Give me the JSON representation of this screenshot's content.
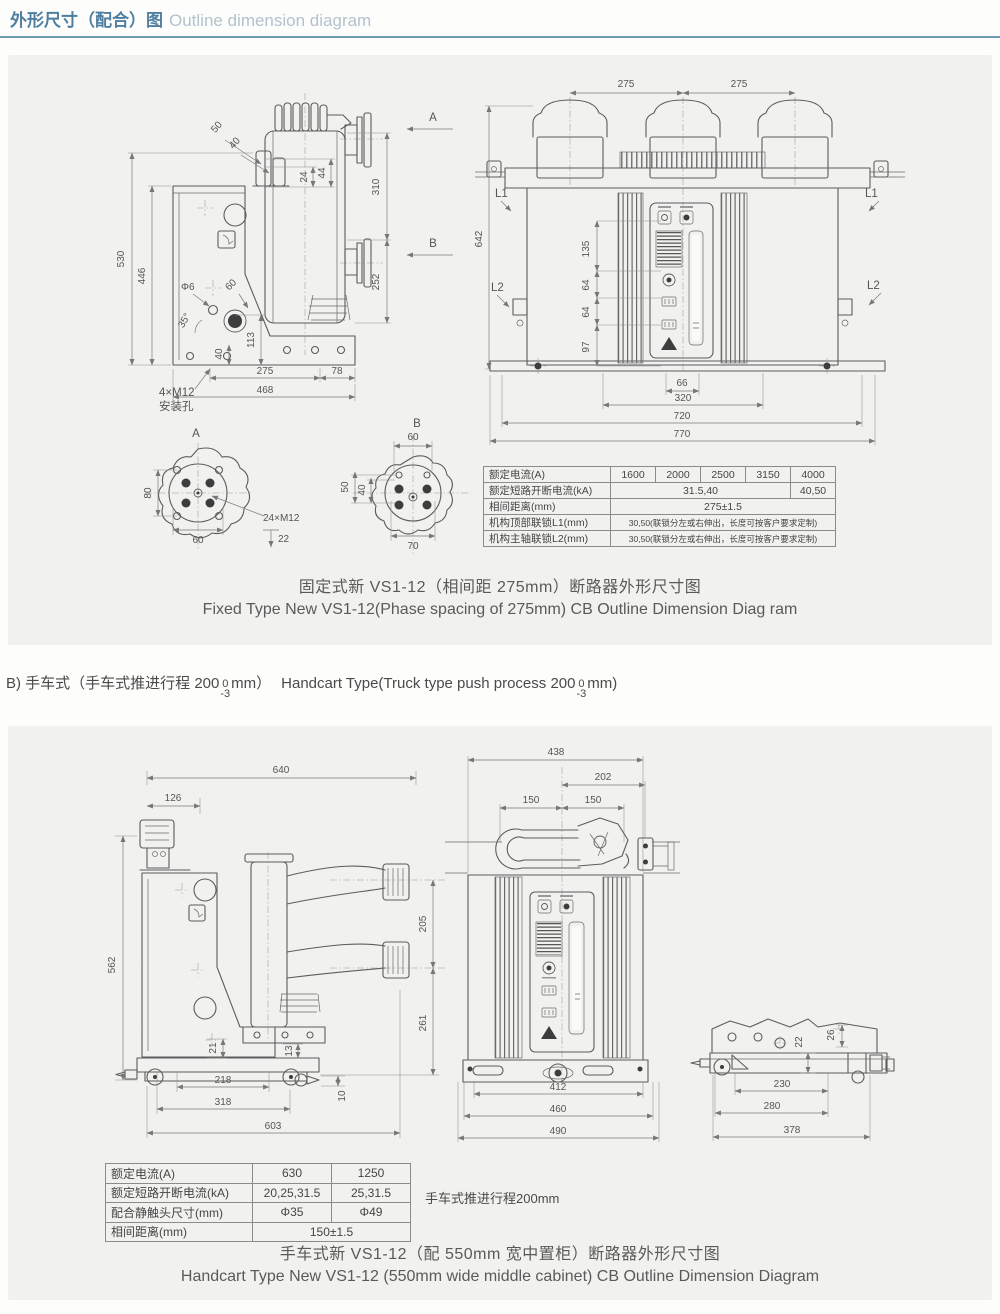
{
  "header": {
    "title_zh": "外形尺寸（配合）图",
    "title_en": "Outline dimension diagram"
  },
  "colors": {
    "title_blue": "#4f7fa0",
    "title_light": "#b2c2ce",
    "divider": "#6f9ab2",
    "panel_bg": "#f1f1ef",
    "drawing_line": "#5c5c5c",
    "text": "#4a4a4a"
  },
  "section_b": {
    "zh_a": "B) 手车式（手车式推进行程 200",
    "tol_top": "0",
    "tol_bot": "-3",
    "zh_b": "mm）",
    "en_a": "Handcart Type(Truck type push process 200",
    "en_b": "mm)"
  },
  "fixed": {
    "caption_zh": "固定式新 VS1-12（相间距 275mm）断路器外形尺寸图",
    "caption_en": "Fixed Type New VS1-12(Phase spacing of 275mm) CB Outline Dimension Diag ram",
    "table": {
      "rows": [
        {
          "label": "额定电流(A)",
          "cells": [
            "1600",
            "2000",
            "2500",
            "3150",
            "4000"
          ]
        },
        {
          "label": "额定短路开断电流(kA)",
          "cells": [
            "31.5,40",
            "40,50"
          ]
        },
        {
          "label": "相间距离(mm)",
          "cells": [
            "275±1.5"
          ]
        },
        {
          "label": "机构顶部联锁L1(mm)",
          "cells": [
            "30,50(联锁分左或右伸出，长度可按客户要求定制)"
          ]
        },
        {
          "label": "机构主轴联锁L2(mm)",
          "cells": [
            "30,50(联锁分左或右伸出，长度可按客户要求定制)"
          ]
        }
      ]
    }
  },
  "handcart": {
    "caption_zh": "手车式新 VS1-12（配 550mm 宽中置柜）断路器外形尺寸图",
    "caption_en": "Handcart Type New VS1-12 (550mm wide middle cabinet) CB Outline Dimension Diagram",
    "note": "手车式推进行程200mm",
    "table": {
      "rows": [
        {
          "label": "额定电流(A)",
          "cells": [
            "630",
            "1250"
          ]
        },
        {
          "label": "额定短路开断电流(kA)",
          "cells": [
            "20,25,31.5",
            "25,31.5"
          ]
        },
        {
          "label": "配合静触头尺寸(mm)",
          "cells": [
            "Φ35",
            "Φ49"
          ]
        },
        {
          "label": "相间距离(mm)",
          "cells": [
            "150±1.5"
          ]
        }
      ]
    }
  },
  "dims": {
    "fs": {
      "h530": "530",
      "h446": "446",
      "a50": "50",
      "a40": "40",
      "r44": "44",
      "r24": "24",
      "v310": "310",
      "v252": "252",
      "phi6": "Φ6",
      "d60": "60",
      "ang35": "35°",
      "v113": "113",
      "v40": "40",
      "m12": "4×M12",
      "mount": "安装孔",
      "w275": "275",
      "w78": "78",
      "w468": "468",
      "secA": "A",
      "secB": "B"
    },
    "ff": {
      "t275l": "275",
      "t275r": "275",
      "h642": "642",
      "l1l": "L1",
      "l1r": "L1",
      "l2l": "L2",
      "l2r": "L2",
      "v135": "135",
      "v64a": "64",
      "v64b": "64",
      "v97": "97",
      "b66": "66",
      "b320": "320",
      "b720": "720",
      "b770": "770"
    },
    "da": {
      "title": "A",
      "v80": "80",
      "b60": "60",
      "note": "24×M12",
      "depth": "22"
    },
    "db": {
      "title": "B",
      "t60": "60",
      "v50": "50",
      "v40": "40",
      "b70": "70"
    },
    "hs": {
      "t640": "640",
      "t126": "126",
      "h562": "562",
      "v205": "205",
      "v261": "261",
      "v21": "21",
      "v13": "13",
      "v10": "10",
      "b218": "218",
      "b318": "318",
      "b603": "603"
    },
    "hf": {
      "t438": "438",
      "t202": "202",
      "t150l": "150",
      "t150r": "150",
      "b412": "412",
      "b460": "460",
      "b490": "490"
    },
    "hc": {
      "v22": "22",
      "v26": "26",
      "b230": "230",
      "b280": "280",
      "b378": "378"
    }
  }
}
